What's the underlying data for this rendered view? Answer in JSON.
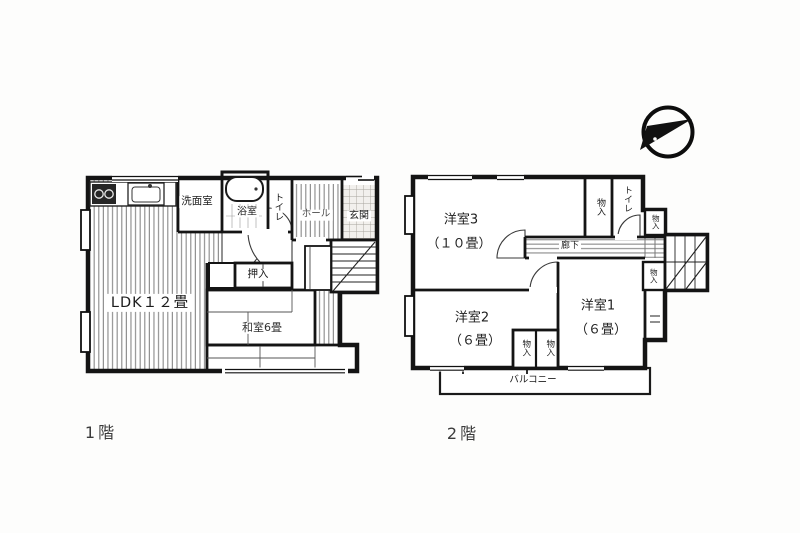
{
  "floor1": {
    "title": "1階",
    "rooms": {
      "ldk": "LDK１２畳",
      "washroom": "洗面室",
      "bathroom": "浴室",
      "toilet": "トイレ",
      "hall": "ホール",
      "entrance": "玄関",
      "closet": "押入",
      "japanese_room": "和室6畳"
    }
  },
  "floor2": {
    "title": "2階",
    "rooms": {
      "western3": "洋室3",
      "western3_size": "（１０畳）",
      "storage_top": "物入",
      "toilet": "トイレ",
      "storage_top_right": "物入",
      "corridor": "廊下",
      "storage_mid_right": "物入",
      "western2": "洋室2",
      "western2_size": "（６畳）",
      "western1": "洋室1",
      "western1_size": "（６畳）",
      "storage_bottom_left": "物入",
      "storage_bottom_right": "物入",
      "balcony": "バルコニー"
    }
  }
}
